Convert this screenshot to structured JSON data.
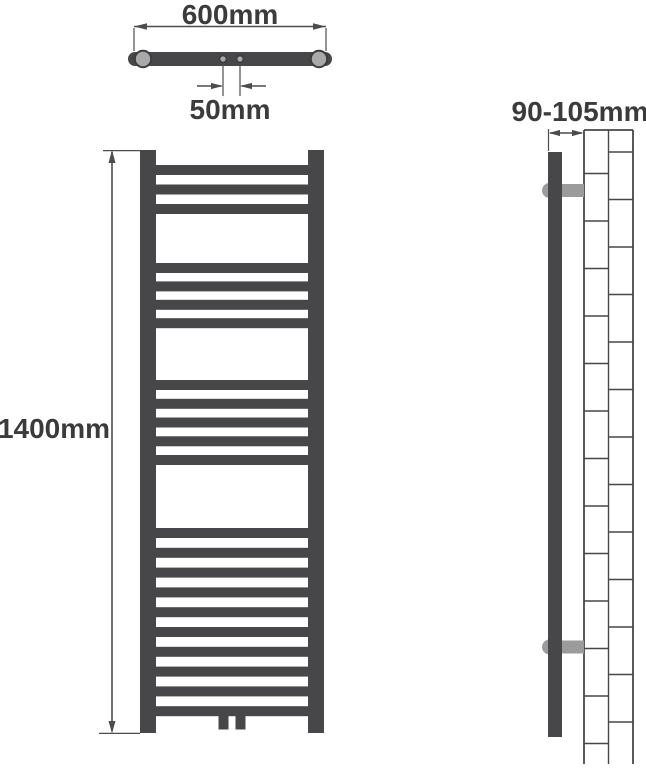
{
  "top_view": {
    "width_label": "600mm",
    "hole_spacing_label": "50mm"
  },
  "front_view": {
    "height_label": "1400mm",
    "rung_groups": [
      3,
      4,
      5,
      10
    ],
    "total_rungs": 22
  },
  "side_view": {
    "depth_label": "90-105mm",
    "bracket_count": 2
  },
  "colors": {
    "radiator_dark": "#474749",
    "bracket_gray": "#9b9b9b",
    "cap_gray": "#a9a9a9",
    "dimension_line": "#4c4c4e",
    "text": "#3b3b3d",
    "background": "#ffffff"
  }
}
